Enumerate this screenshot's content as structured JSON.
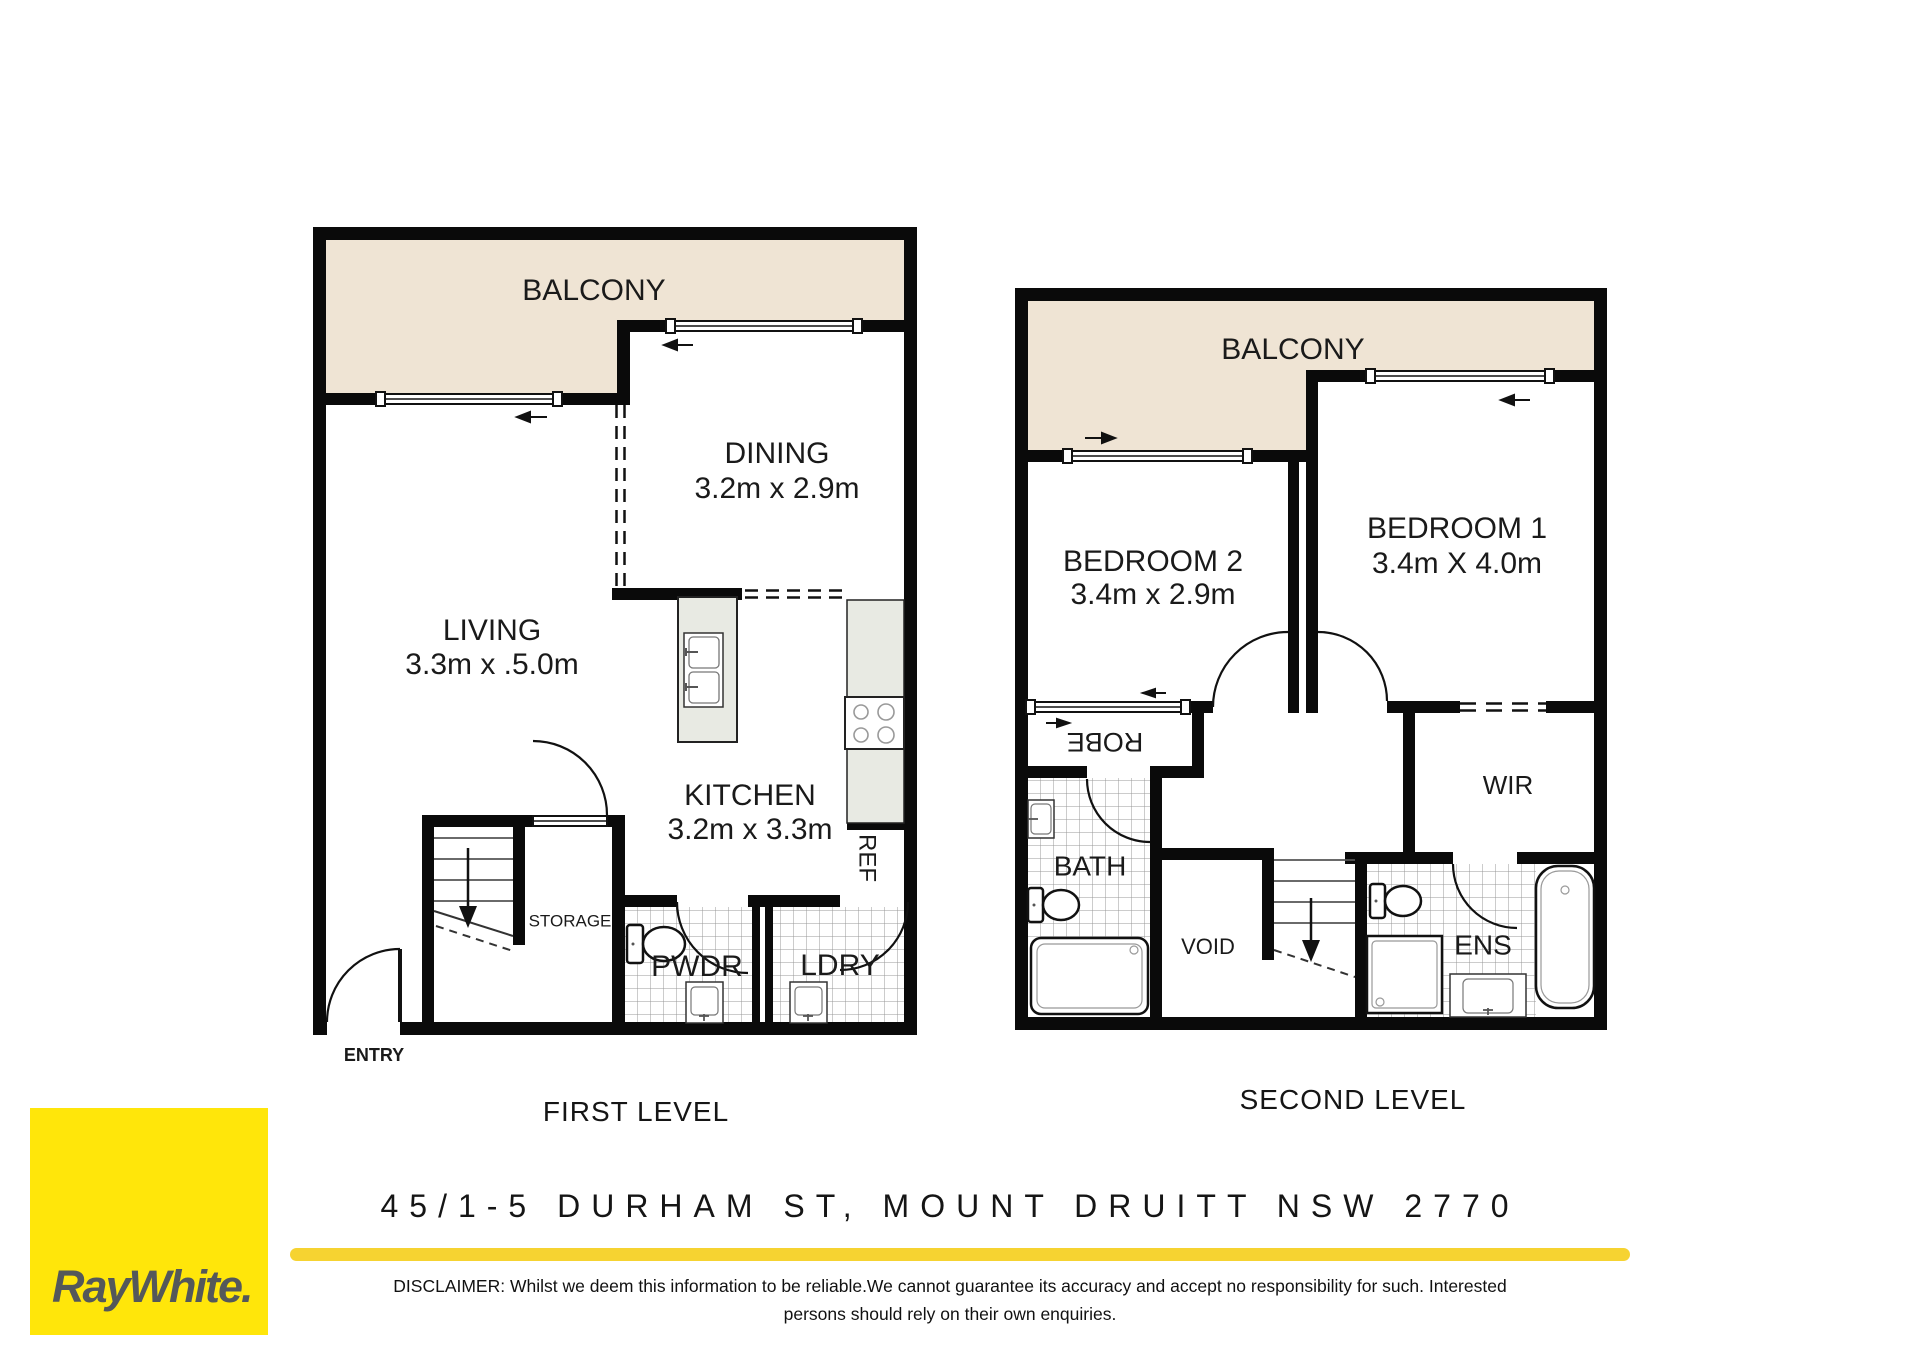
{
  "first_level": {
    "caption": "FIRST LEVEL",
    "balcony_label": "BALCONY",
    "dining": {
      "name": "DINING",
      "dims": "3.2m x 2.9m"
    },
    "living": {
      "name": "LIVING",
      "dims": "3.3m x .5.0m"
    },
    "kitchen": {
      "name": "KITCHEN",
      "dims": "3.2m x 3.3m"
    },
    "ref_label": "REF",
    "storage_label": "STORAGE",
    "pwdr_label": "PWDR",
    "ldry_label": "LDRY",
    "entry_label": "ENTRY"
  },
  "second_level": {
    "caption": "SECOND LEVEL",
    "balcony_label": "BALCONY",
    "bedroom2": {
      "name": "BEDROOM 2",
      "dims": "3.4m x 2.9m"
    },
    "bedroom1": {
      "name": "BEDROOM 1",
      "dims": "3.4m X 4.0m"
    },
    "robe_label": "ROBE",
    "bath_label": "BATH",
    "void_label": "VOID",
    "wir_label": "WIR",
    "ens_label": "ENS"
  },
  "address": "45/1-5 DURHAM ST, MOUNT DRUITT NSW 2770",
  "brand": {
    "logo_text": "RayWhite."
  },
  "disclaimer": {
    "line1": "DISCLAIMER: Whilst we deem this information to be reliable.We cannot guarantee its accuracy and accept no responsibility for such. Interested",
    "line2": "persons should rely on their own enquiries."
  },
  "colors": {
    "wall": "#0a0a0a",
    "balcony_fill": "#efe4d4",
    "counter_fill": "#e8eae3",
    "divider_yellow": "#f6d331",
    "brand_yellow": "#ffe60a",
    "brand_text_gray": "#54585a",
    "tile_line": "#999999"
  }
}
